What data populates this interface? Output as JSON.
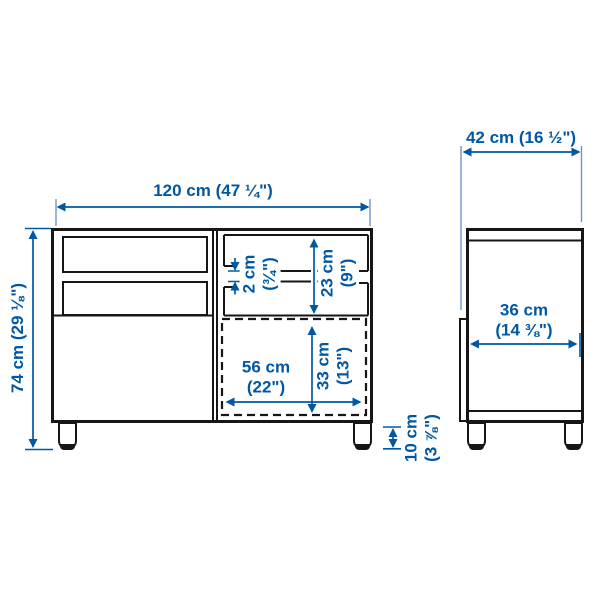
{
  "colors": {
    "dimension_blue": "#0058a3",
    "extension_blue": "#6f93c9",
    "line_black": "#161616",
    "background": "#ffffff"
  },
  "front_view": {
    "width_label": "120 cm (47 ¼\")",
    "height_label": "74 cm (29 ⅛\")",
    "shelf_thickness": {
      "cm": "2 cm",
      "inches": "(¾\")"
    },
    "compartment_height": {
      "cm": "23 cm",
      "inches": "(9\")"
    },
    "door_width": {
      "cm": "56 cm",
      "inches": "(22\")"
    },
    "door_height": {
      "cm": "33 cm",
      "inches": "(13\")"
    },
    "leg_height": {
      "cm": "10 cm",
      "inches": "(3 ⅞\")"
    }
  },
  "side_view": {
    "depth_label": "42 cm (16 ½\")",
    "inner_depth": {
      "cm": "36 cm",
      "inches": "(14 ⅜\")"
    }
  }
}
